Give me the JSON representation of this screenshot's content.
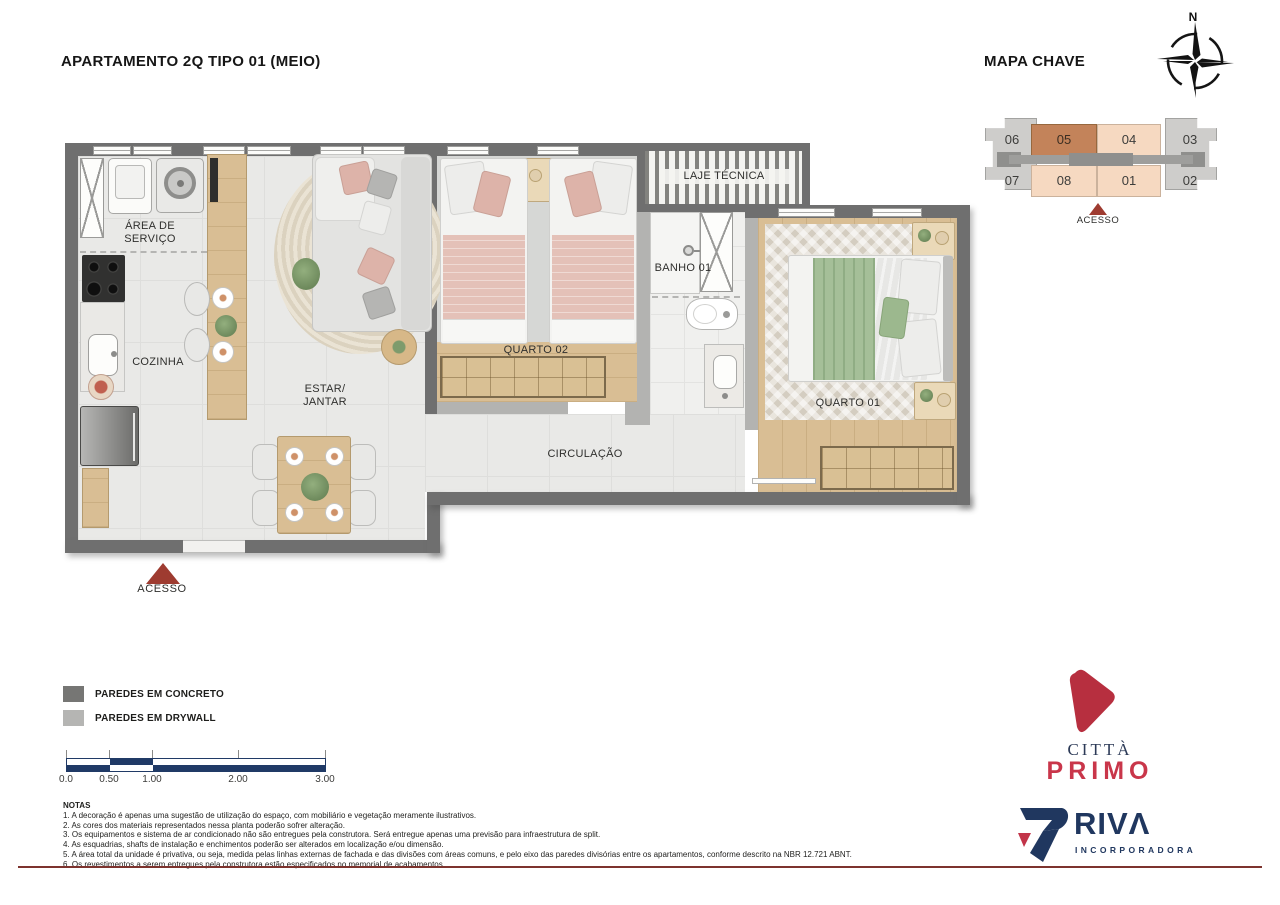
{
  "page": {
    "title": "APARTAMENTO 2Q TIPO 01 (MEIO)"
  },
  "key_map": {
    "heading": "MAPA CHAVE",
    "compass_north": "N",
    "units_top": [
      "06",
      "05",
      "04",
      "03"
    ],
    "units_bottom": [
      "07",
      "08",
      "01",
      "02"
    ],
    "highlighted_unit": "05",
    "access_label": "ACESSO",
    "colors": {
      "unit_fill": "#f6d9c1",
      "highlight_fill": "#c3835a",
      "end_block_fill": "#cecdcb",
      "corridor_fill": "#9b9b99",
      "access_marker": "#9e3b30"
    }
  },
  "plan": {
    "labels": {
      "area_servico": "ÁREA DE\nSERVIÇO",
      "cozinha": "COZINHA",
      "estar_jantar": "ESTAR/\nJANTAR",
      "quarto02": "QUARTO 02",
      "banho01": "BANHO 01",
      "laje_tecnica": "LAJE TÉCNICA",
      "quarto01": "QUARTO 01",
      "circulacao": "CIRCULAÇÃO",
      "acesso": "ACESSO"
    },
    "colors": {
      "concrete_wall": "#6f6f6f",
      "drywall": "#b3b3b1",
      "access_marker": "#9e3b30"
    }
  },
  "legend": {
    "items": [
      {
        "label": "PAREDES EM CONCRETO",
        "color": "#767674"
      },
      {
        "label": "PAREDES EM DRYWALL",
        "color": "#b5b5b3"
      }
    ]
  },
  "scale_bar": {
    "tick_labels": [
      "0.0",
      "0.50",
      "1.00",
      "2.00",
      "3.00"
    ],
    "bar_color": "#203a66"
  },
  "notes": {
    "heading": "NOTAS",
    "lines": [
      "1. A decoração é apenas uma sugestão de utilização do espaço, com mobiliário e vegetação meramente ilustrativos.",
      "2. As cores dos materiais representados nessa planta poderão sofrer alteração.",
      "3. Os equipamentos e sistema de ar condicionado não são entregues pela construtora. Será entregue apenas uma previsão para infraestrutura de split.",
      "4. As esquadrias, shafts de instalação e enchimentos poderão ser alterados em localização e/ou dimensão.",
      "5. A área total da unidade é privativa, ou seja, medida pelas linhas externas de fachada e das divisões com áreas comuns, e pelo eixo das paredes divisórias entre os apartamentos, conforme descrito na NBR 12.721 ABNT.",
      "6. Os revestimentos a serem entregues pela construtora estão especificados no memorial de acabamentos."
    ]
  },
  "logos": {
    "citta": {
      "line1": "CITTÀ",
      "line2": "PRIMO",
      "mark_color": "#b72f3f",
      "navy": "#2c3a57",
      "red": "#c9364a"
    },
    "riva": {
      "name": "RIVΛ",
      "subtitle": "INCORPORADORA",
      "navy": "#20375f",
      "red": "#c23449"
    }
  }
}
